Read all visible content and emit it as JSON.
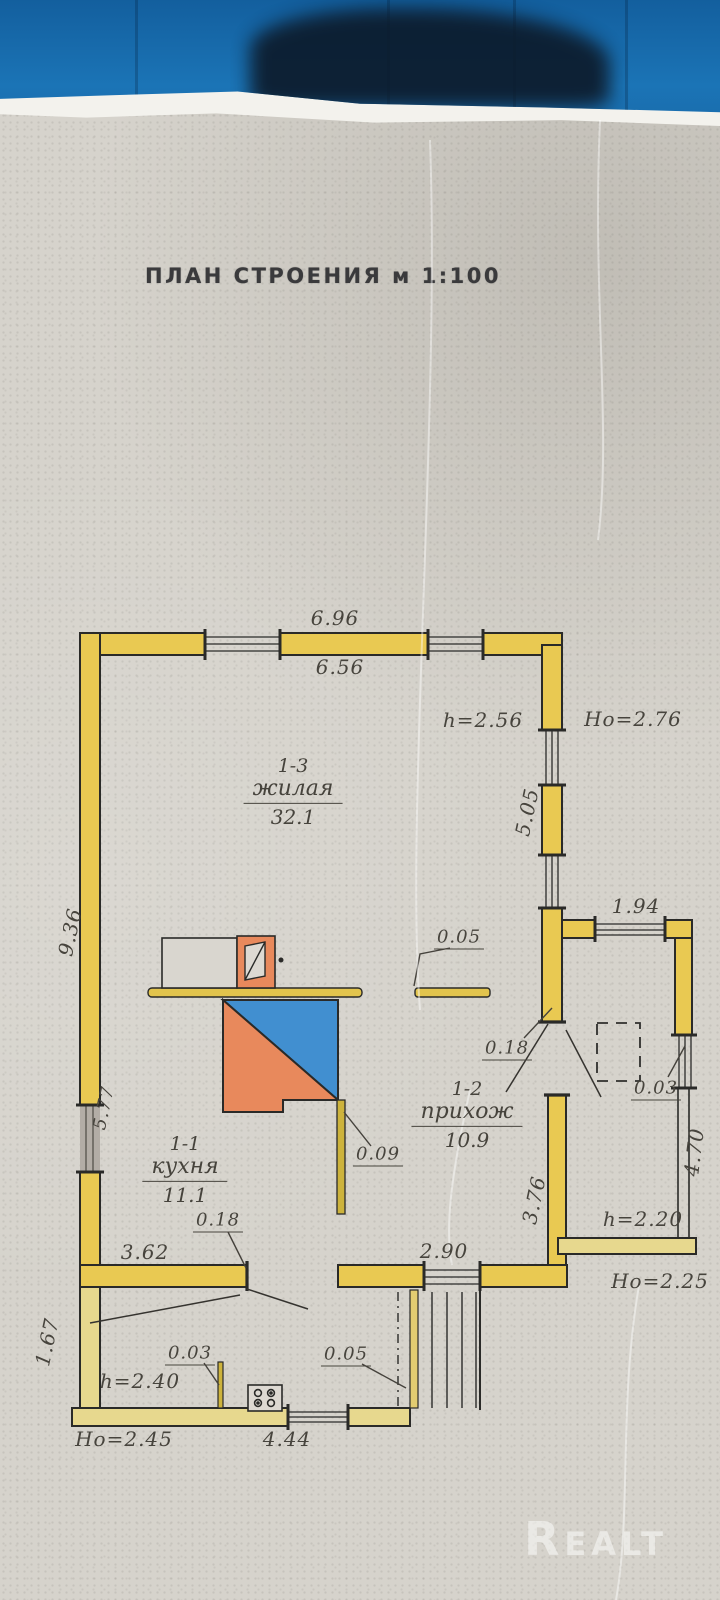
{
  "photo": {
    "background_color": "#1b74b6",
    "watermark": "Realt"
  },
  "document": {
    "title": "ПЛАН СТРОЕНИЯ м 1:100",
    "paper_color": "#d6d3cc"
  },
  "plan": {
    "wall_color": "#e9c952",
    "stove_blue": "#418fd0",
    "stove_orange": "#e8895c",
    "rooms": [
      {
        "id": "1-3",
        "name": "жилая",
        "area": "32.1"
      },
      {
        "id": "1-1",
        "name": "кухня",
        "area": "11.1"
      },
      {
        "id": "1-2",
        "name": "прихож",
        "area": "10.9"
      }
    ],
    "dimensions": {
      "top_outer": "6.96",
      "top_inner": "6.56",
      "h_main": "h=2.56",
      "ho_main": "Ho=2.76",
      "right_wall": "5.05",
      "left_wall": "9.36",
      "left_wall_lower": "5.77",
      "annex_top": "1.94",
      "annex_wall_thk": "0.03",
      "annex_right": "4.70",
      "annex_h": "h=2.20",
      "annex_ho": "Ho=2.25",
      "shelf_thk": "0.05",
      "entry_wall_thk": "0.18",
      "partition_thk": "0.09",
      "hall_wall": "3.76",
      "hall_width": "2.90",
      "kitchen_width": "3.62",
      "kitchen_wall_thk": "0.18",
      "porch_left": "1.67",
      "porch_part_thk": "0.03",
      "porch_h": "h=2.40",
      "porch_stub_thk": "0.05",
      "porch_ho": "Ho=2.45",
      "porch_width": "4.44"
    }
  }
}
